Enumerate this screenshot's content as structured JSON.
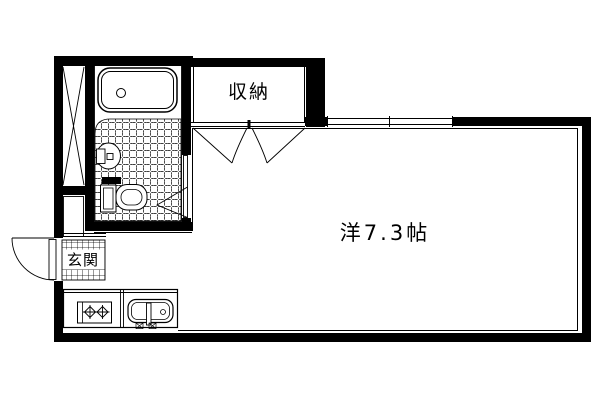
{
  "floorplan": {
    "background_color": "#ffffff",
    "line_color": "#000000",
    "rooms": {
      "closet": {
        "label": "収納"
      },
      "western_room": {
        "label": "洋7.3帖",
        "size_tatami": "7.3"
      },
      "entrance": {
        "label": "玄関"
      }
    },
    "fixtures": [
      "bathtub",
      "wash-basin",
      "toilet",
      "tiled-bath-floor",
      "pipe-space-shaft",
      "closet-double-doors",
      "bathroom-folding-door",
      "entrance-swing-door",
      "two-burner-stove",
      "kitchen-sink",
      "sliding-window"
    ]
  }
}
